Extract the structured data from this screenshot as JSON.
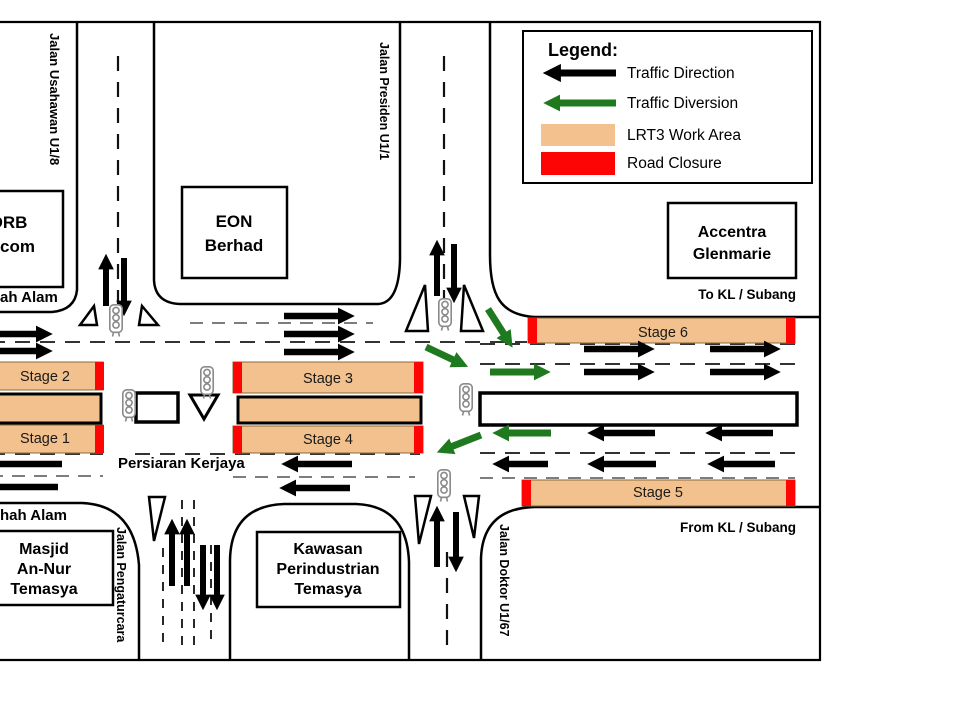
{
  "legend": {
    "title": "Legend:",
    "items": [
      {
        "label": "Traffic Direction"
      },
      {
        "label": "Traffic Diversion"
      },
      {
        "label": "LRT3 Work Area"
      },
      {
        "label": "Road Closure"
      }
    ]
  },
  "stages": {
    "s1": "Stage 1",
    "s2": "Stage 2",
    "s3": "Stage 3",
    "s4": "Stage 4",
    "s5": "Stage 5",
    "s6": "Stage 6"
  },
  "buildings": {
    "drb": [
      "DRB",
      "Hicom"
    ],
    "eon": [
      "EON",
      "Berhad"
    ],
    "accentra": [
      "Accentra",
      "Glenmarie"
    ],
    "masjid": [
      "Masjid",
      "An-Nur",
      "Temasya"
    ],
    "kawasan": [
      "Kawasan",
      "Perindustrian",
      "Temasya"
    ]
  },
  "roads": {
    "usahawan": "Jalan Usahawan U1/8",
    "presiden": "Jalan Presiden U1/1",
    "pengaturcara": "Jalan Pengaturcara",
    "doktor": "Jalan Doktor U1/67",
    "persiaran": "Persiaran Kerjaya"
  },
  "labels": {
    "to_kl": "To KL / Subang",
    "from_kl": "From KL / Subang",
    "shah_alam_top": "ah Alam",
    "shah_alam_bottom": "hah Alam"
  },
  "colors": {
    "work_area": "#F2C18D",
    "road_closure": "#FE0505",
    "traffic_direction": "#000000",
    "traffic_diversion": "#1F7A1F"
  }
}
